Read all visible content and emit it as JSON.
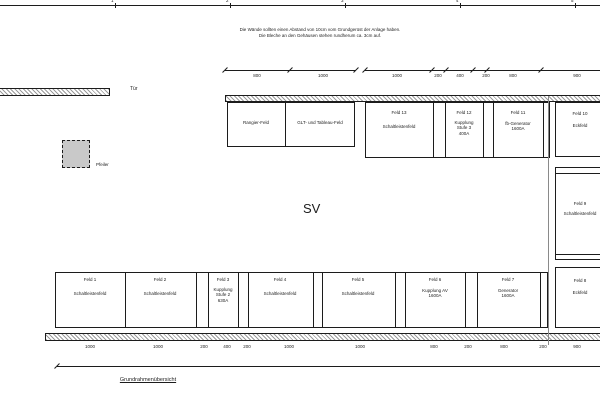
{
  "sheet": {
    "grid_labels": [
      "1",
      "2",
      "3",
      "4",
      "5"
    ]
  },
  "note": {
    "line1": "Die Wände sollten einen Abstand von 10cm vom Grundgerüst der Anlage haben.",
    "line2": "Die Bleche an den Gehäusen stehen rundherum ca. 3cm auf."
  },
  "labels": {
    "door": "Tür",
    "pillar": "Pfeiler",
    "room": "SV",
    "drawing_title": "Grundrahmenübersicht"
  },
  "dims": {
    "top_left": [
      "800",
      "1000"
    ],
    "top_right": [
      "1000",
      "200",
      "400",
      "200",
      "800",
      "900"
    ],
    "bottom": [
      "1000",
      "1000",
      "200",
      "400",
      "200",
      "1000",
      "1000",
      "800",
      "200",
      "800",
      "200",
      "900"
    ]
  },
  "fields": {
    "top_row": [
      {
        "lines": [
          "Rangier-Feld"
        ]
      },
      {
        "lines": [
          "GLT- und Tableau-Feld"
        ]
      },
      {
        "lines": [
          "Feld 13",
          "Schaltleistenfeld"
        ]
      },
      {
        "lines": [
          "Feld 12",
          "Kupplung",
          "Stufe 3",
          "400A"
        ]
      },
      {
        "lines": [
          "Feld 11",
          "fb-Generator",
          "1600A"
        ]
      }
    ],
    "right_column": [
      {
        "lines": [
          "Feld 10",
          "Eckfeld"
        ]
      },
      {
        "lines": [
          "Feld 9",
          "Schaltleistenfeld"
        ]
      },
      {
        "lines": [
          "Feld 8",
          "Eckfeld"
        ]
      }
    ],
    "bottom_row": [
      {
        "lines": [
          "Feld 1",
          "Schaltleistenfeld"
        ]
      },
      {
        "lines": [
          "Feld 2",
          "Schaltleistenfeld"
        ]
      },
      {
        "lines": [
          "Feld 3",
          "Kupplung",
          "Stufe 2",
          "630A"
        ]
      },
      {
        "lines": [
          "Feld 4",
          "Schaltleistenfeld"
        ]
      },
      {
        "lines": [
          "Feld 5",
          "Schaltleistenfeld"
        ]
      },
      {
        "lines": [
          "Feld 6",
          "Kupplung AV",
          "1600A"
        ]
      },
      {
        "lines": [
          "Feld 7",
          "Generator",
          "1600A"
        ]
      }
    ]
  },
  "colors": {
    "line": "#1c1c1c",
    "hatch": "#9b9b9b",
    "pillar_fill": "#c9c9c9",
    "background": "#ffffff"
  }
}
